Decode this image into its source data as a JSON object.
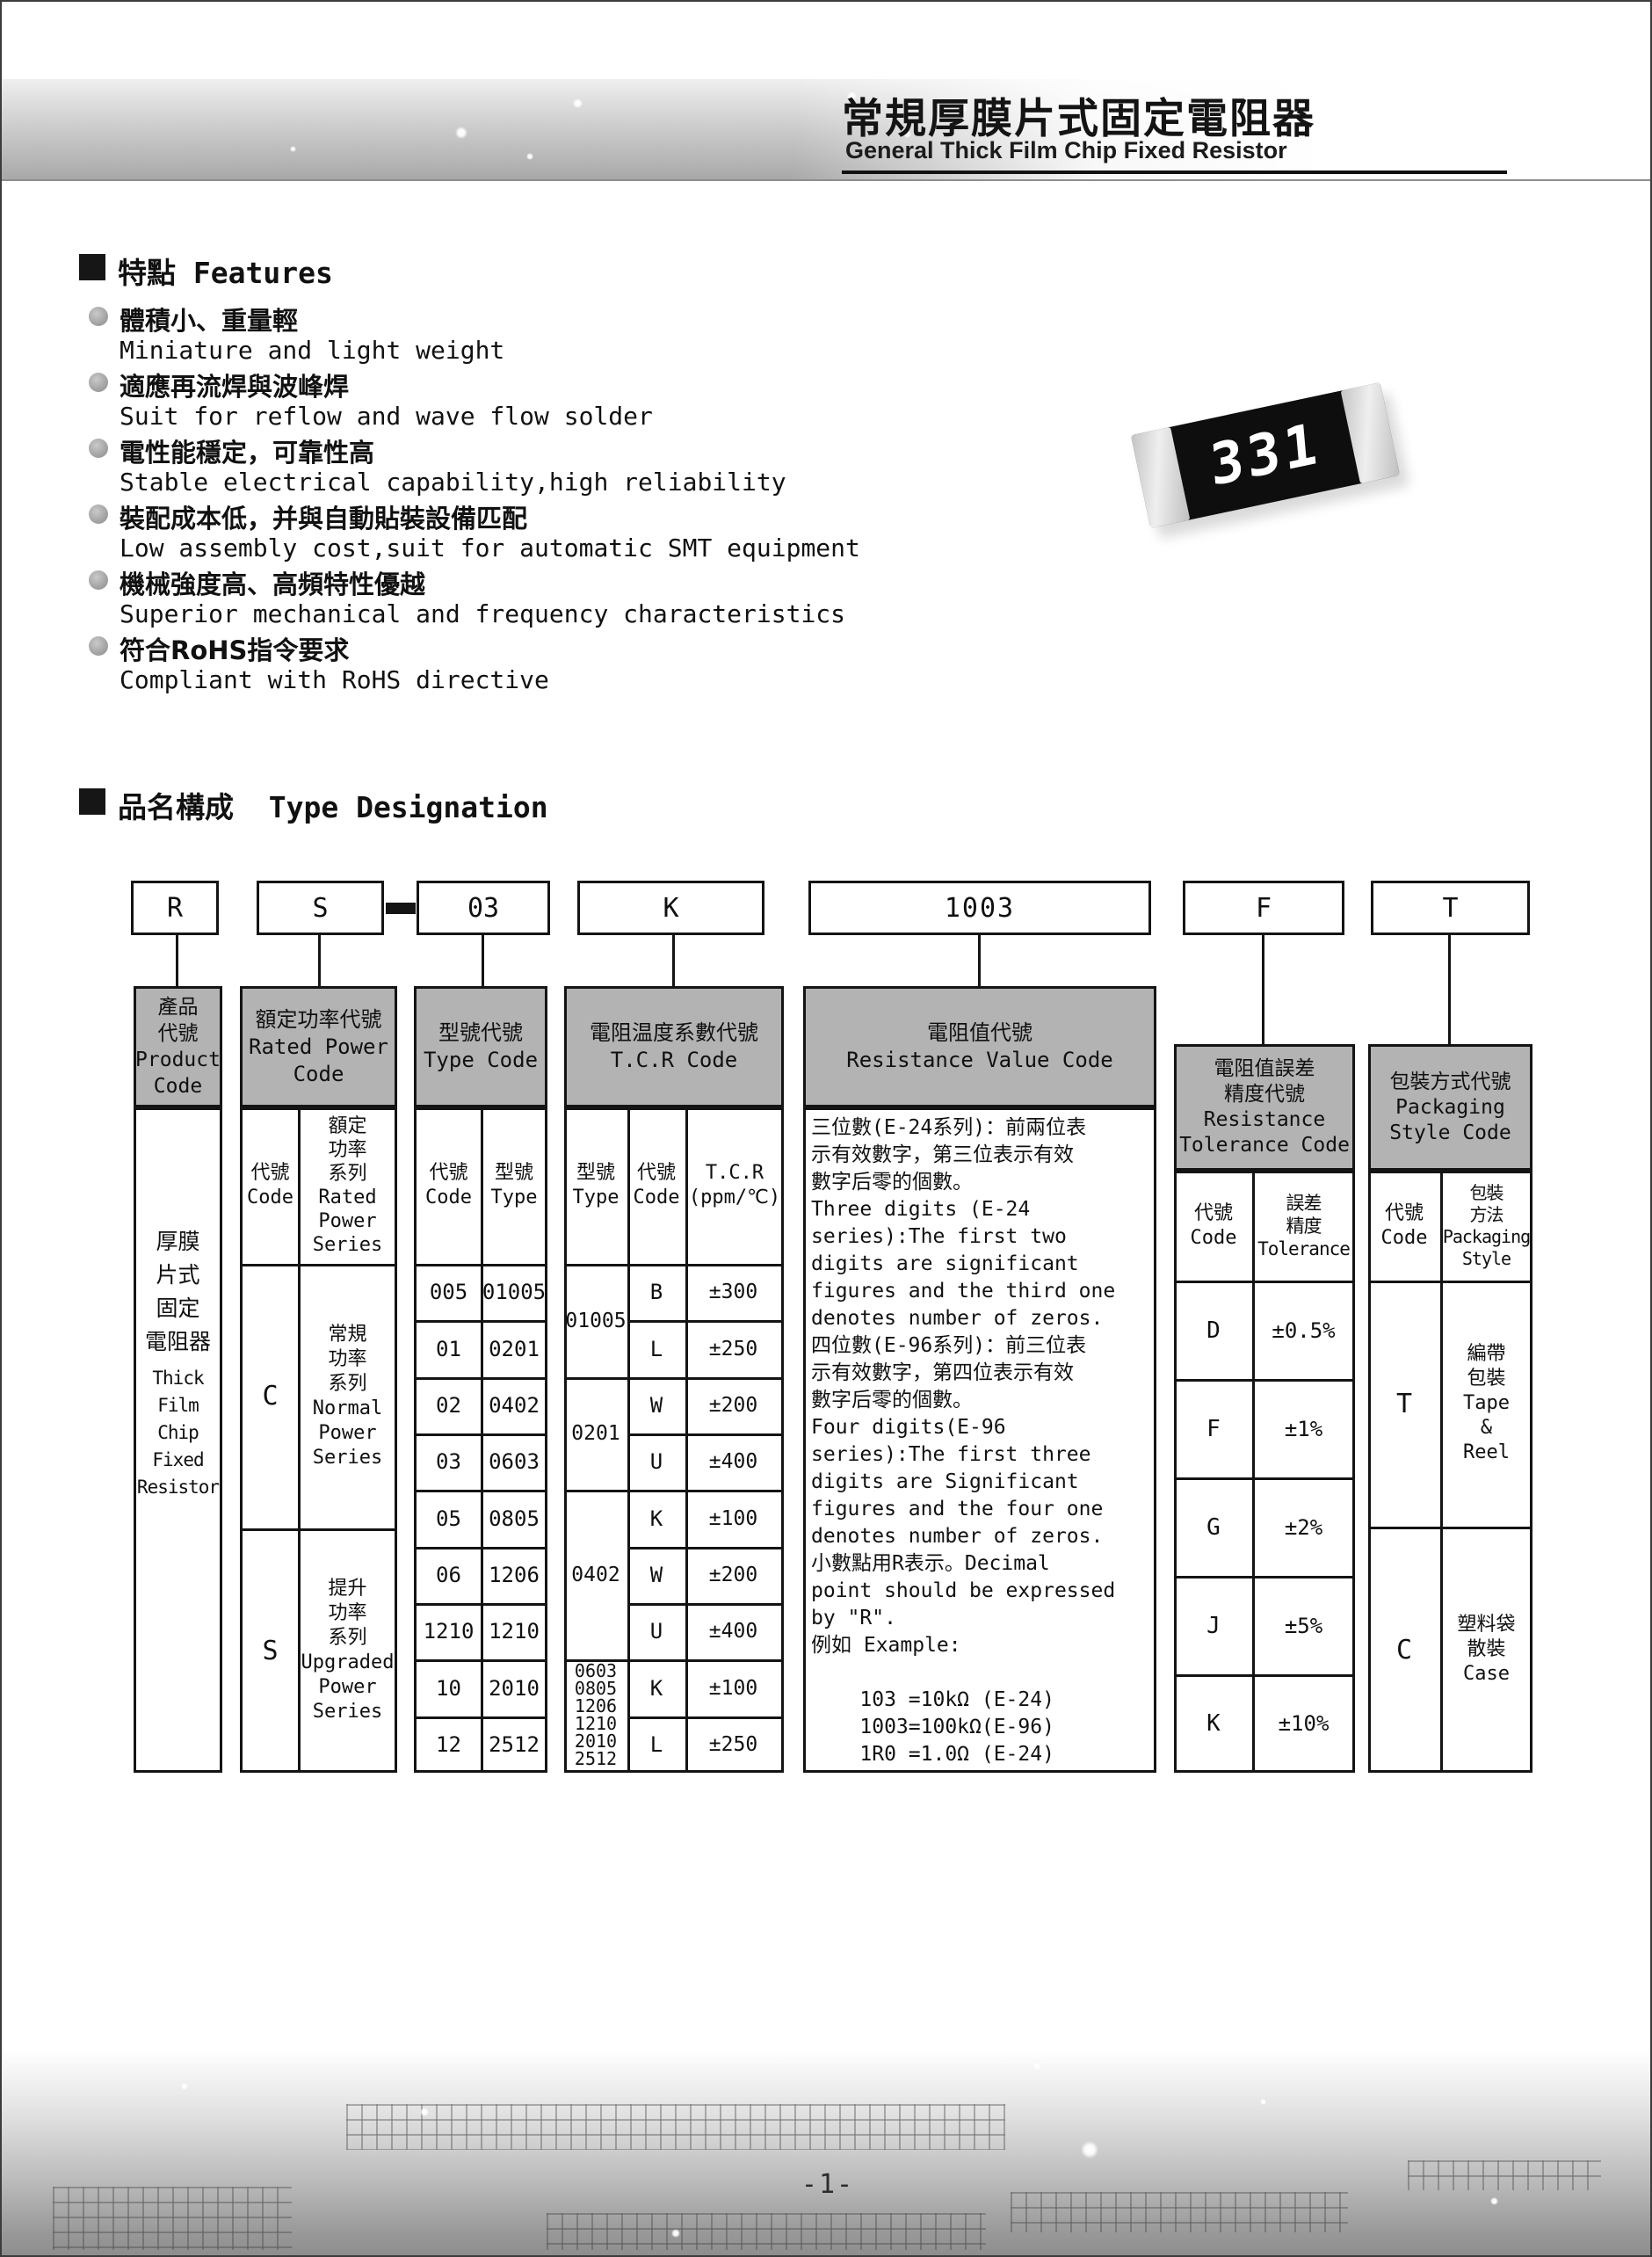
{
  "header": {
    "title_zh": "常規厚膜片式固定電阻器",
    "title_en": "General Thick Film Chip Fixed Resistor"
  },
  "features": {
    "heading": "特點 Features",
    "items": [
      {
        "zh": "體積小、重量輕",
        "en": "Miniature and light weight"
      },
      {
        "zh": "適應再流焊與波峰焊",
        "en": "Suit for reflow and wave flow solder"
      },
      {
        "zh": "電性能穩定，可靠性高",
        "en": "Stable electrical capability,high reliability"
      },
      {
        "zh": "裝配成本低，并與自動貼裝設備匹配",
        "en": "Low assembly cost,suit for automatic SMT equipment"
      },
      {
        "zh": "機械強度高、高頻特性優越",
        "en": "Superior mechanical and frequency characteristics"
      },
      {
        "zh": "符合RoHS指令要求",
        "en": "Compliant with RoHS directive"
      }
    ]
  },
  "chip": {
    "marking": "331"
  },
  "designation": {
    "heading": "品名構成  Type Designation",
    "boxes": {
      "product": "R",
      "power": "S",
      "separator_dash": "-",
      "type": "03",
      "tcr": "K",
      "value": "1003",
      "tolerance": "F",
      "packaging": "T"
    },
    "columns": {
      "product": {
        "header": "產品\n代號\nProduct\nCode",
        "body_zh": "厚膜\n片式\n固定\n電阻器",
        "body_en": "Thick\nFilm\nChip\nFixed\nResistor"
      },
      "power": {
        "header": "額定功率代號\nRated Power\nCode",
        "sub_code": "代號\nCode",
        "sub_series": "額定\n功率\n系列\nRated\nPower\nSeries",
        "rows": [
          {
            "code": "C",
            "series": "常規\n功率\n系列\nNormal\nPower\nSeries"
          },
          {
            "code": "S",
            "series": "提升\n功率\n系列\nUpgraded\nPower\nSeries"
          }
        ]
      },
      "type": {
        "header": "型號代號\nType Code",
        "sub_code": "代號\nCode",
        "sub_type": "型號\nType",
        "rows": [
          {
            "code": "005",
            "type": "01005"
          },
          {
            "code": "01",
            "type": "0201"
          },
          {
            "code": "02",
            "type": "0402"
          },
          {
            "code": "03",
            "type": "0603"
          },
          {
            "code": "05",
            "type": "0805"
          },
          {
            "code": "06",
            "type": "1206"
          },
          {
            "code": "1210",
            "type": "1210"
          },
          {
            "code": "10",
            "type": "2010"
          },
          {
            "code": "12",
            "type": "2512"
          }
        ]
      },
      "tcr": {
        "header": "電阻温度系數代號\nT.C.R Code",
        "sub_type": "型號\nType",
        "sub_code": "代號\nCode",
        "sub_tcr": "T.C.R\n(ppm/℃)",
        "groups": [
          {
            "type": "01005",
            "rows": [
              {
                "code": "B",
                "tcr": "±300"
              },
              {
                "code": "L",
                "tcr": "±250"
              }
            ]
          },
          {
            "type": "0201",
            "rows": [
              {
                "code": "W",
                "tcr": "±200"
              },
              {
                "code": "U",
                "tcr": "±400"
              }
            ]
          },
          {
            "type": "0402",
            "rows": [
              {
                "code": "K",
                "tcr": "±100"
              },
              {
                "code": "W",
                "tcr": "±200"
              },
              {
                "code": "U",
                "tcr": "±400"
              }
            ]
          },
          {
            "type": "0603\n0805\n1206\n1210\n2010\n2512",
            "rows": [
              {
                "code": "K",
                "tcr": "±100"
              },
              {
                "code": "L",
                "tcr": "±250"
              }
            ]
          }
        ]
      },
      "value": {
        "header": "電阻值代號\nResistance Value Code",
        "body": "三位數(E-24系列)：前兩位表\n示有效數字，第三位表示有效\n數字后零的個數。\nThree digits (E-24\nseries):The first two\ndigits are significant\nfigures and the third one\ndenotes number of zeros.\n四位數(E-96系列)：前三位表\n示有效數字，第四位表示有效\n數字后零的個數。\nFour digits(E-96\nseries):The first three\ndigits are Significant\nfigures and the four one\ndenotes number of zeros.\n小數點用R表示。Decimal\npoint should be expressed\nby \"R\".\n例如 Example:\n\n    103 =10kΩ (E-24)\n    1003=100kΩ(E-96)\n    1R0 =1.0Ω (E-24)"
      },
      "tolerance": {
        "header": "電阻值誤差\n精度代號\nResistance\nTolerance Code",
        "sub_code": "代號\nCode",
        "sub_tol": "誤差\n精度\nTolerance",
        "rows": [
          {
            "code": "D",
            "tol": "±0.5%"
          },
          {
            "code": "F",
            "tol": "±1%"
          },
          {
            "code": "G",
            "tol": "±2%"
          },
          {
            "code": "J",
            "tol": "±5%"
          },
          {
            "code": "K",
            "tol": "±10%"
          }
        ]
      },
      "packaging": {
        "header": "包裝方式代號\nPackaging\nStyle Code",
        "sub_code": "代號\nCode",
        "sub_style": "包裝\n方法\nPackaging\nStyle",
        "rows": [
          {
            "code": "T",
            "style": "編帶\n包裝\nTape\n&\nReel"
          },
          {
            "code": "C",
            "style": "塑料袋\n散裝\nCase"
          }
        ]
      }
    }
  },
  "footer": {
    "page_number": "-1-"
  }
}
